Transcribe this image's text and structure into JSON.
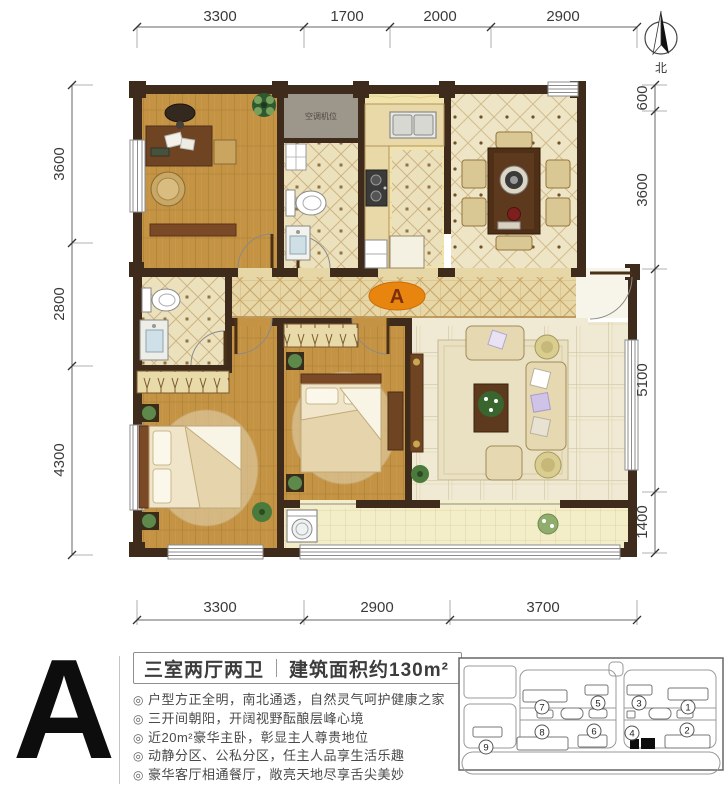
{
  "plan": {
    "marker_label": "A",
    "ac_label": "空调机位"
  },
  "north": {
    "label": "北"
  },
  "dimensions": {
    "top": [
      "3300",
      "1700",
      "2000",
      "2900"
    ],
    "left": [
      "3600",
      "2800",
      "4300"
    ],
    "right": [
      "600",
      "3600",
      "5100",
      "1400"
    ],
    "bottom": [
      "3300",
      "2900",
      "3700"
    ]
  },
  "info": {
    "unit_letter": "A",
    "layout_type": "三室两厅两卫",
    "area_label": "建筑面积约130m²",
    "bullet": "◎",
    "features": [
      "户型方正全明，南北通透，自然灵气呵护健康之家",
      "三开间朝阳，开阔视野酝酿层峰心境",
      "近20m²豪华主卧，彰显主人尊贵地位",
      "动静分区、公私分区，任主人品享生活乐趣",
      "豪华客厅相通餐厅，敞亮天地尽享舌尖美妙"
    ]
  },
  "site_map": {
    "labels": [
      "1",
      "2",
      "3",
      "4",
      "5",
      "6",
      "7",
      "8",
      "9"
    ]
  },
  "colors": {
    "accent_orange": "#E8850E",
    "wall_brown": "#3E2B1B",
    "wood_floor": "#C49344"
  }
}
